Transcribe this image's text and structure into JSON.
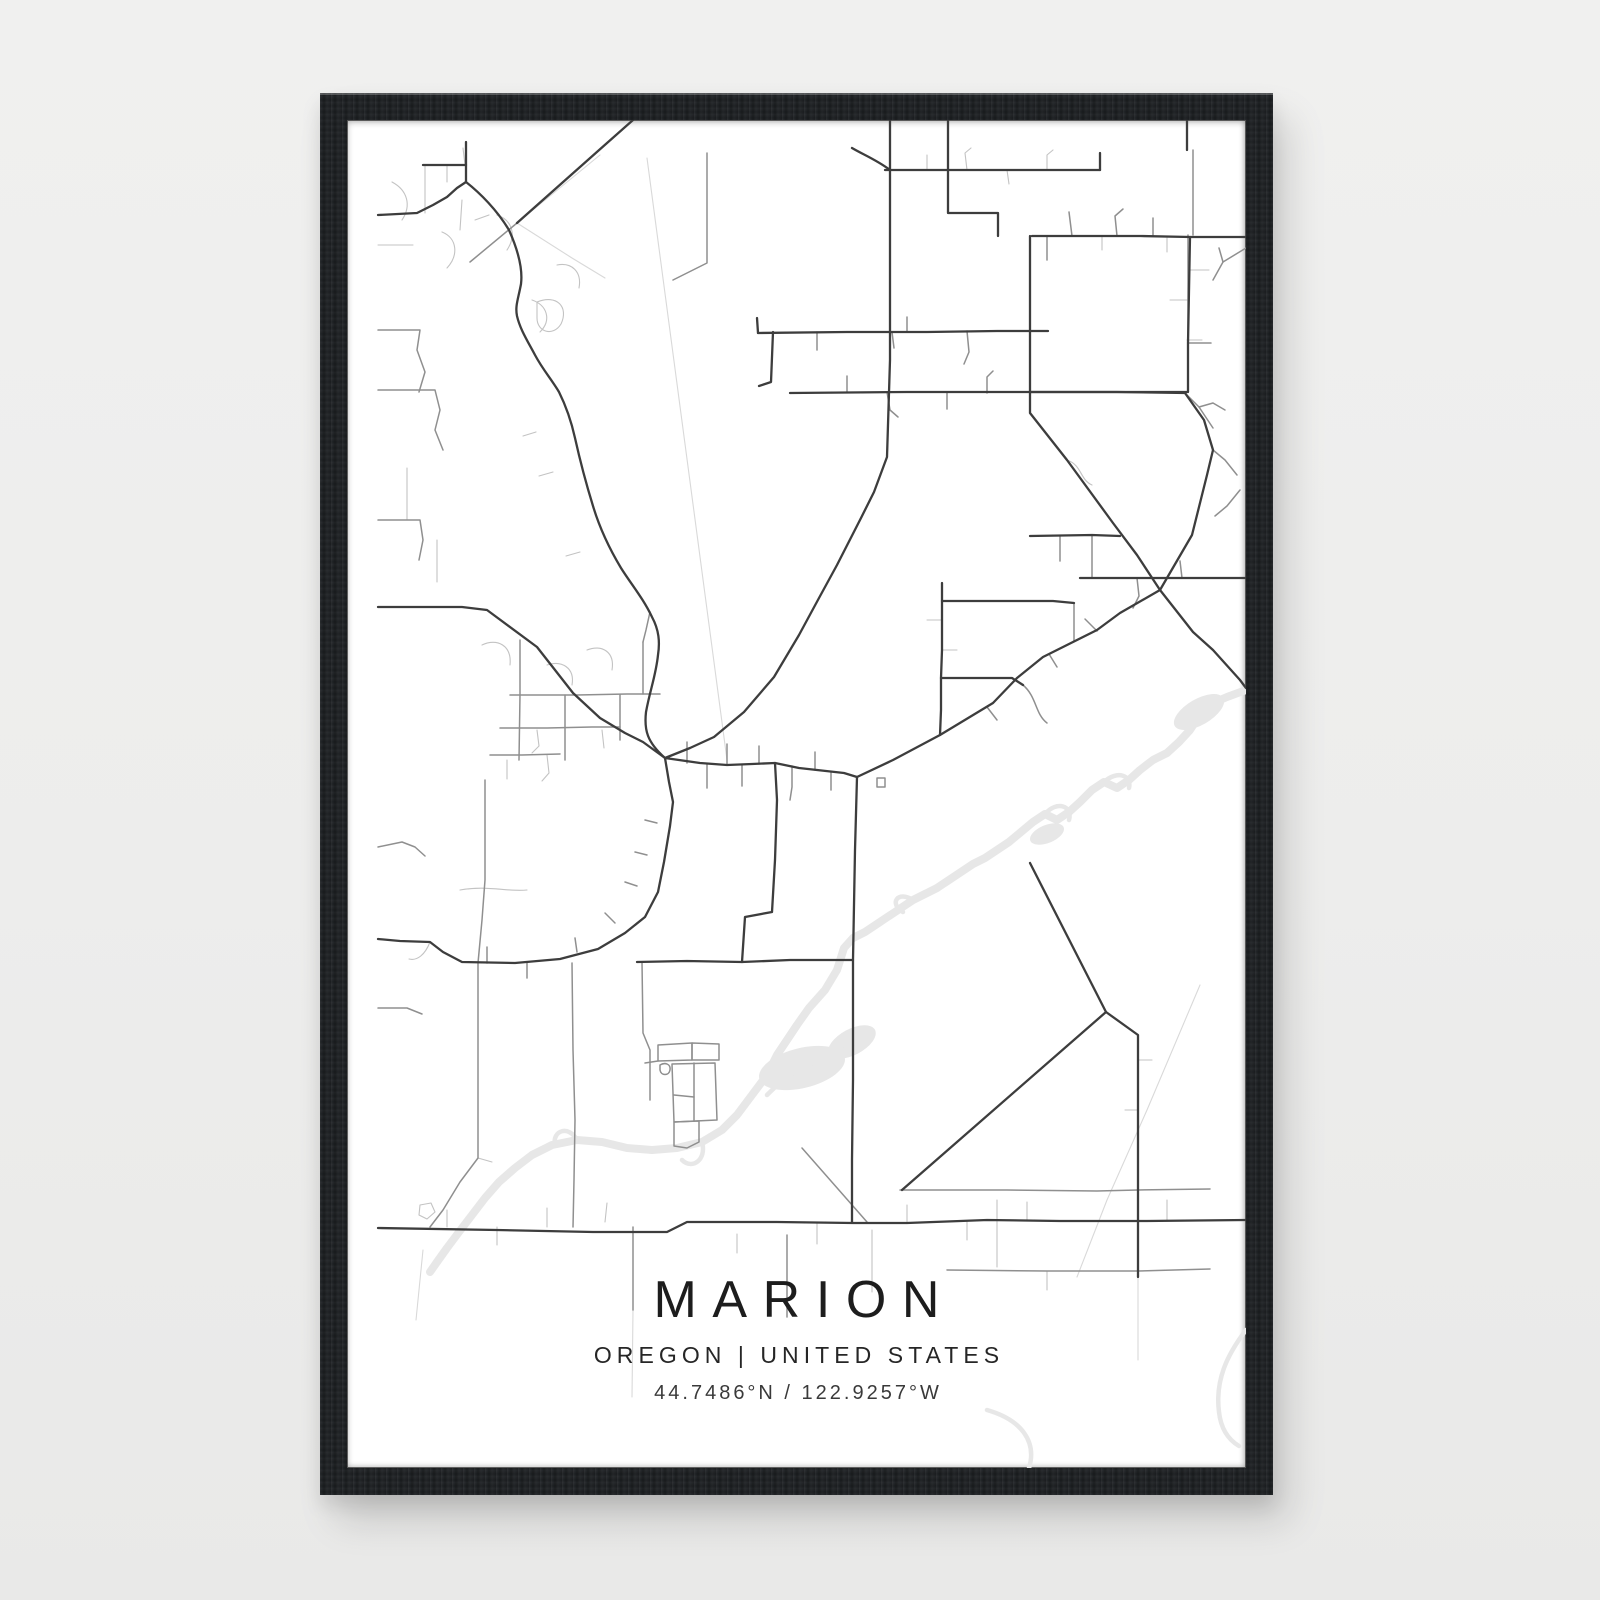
{
  "scene": {
    "background": "#eeeeee",
    "description": "framed-map-poster-product-photo"
  },
  "frame": {
    "color": "#202326",
    "material": "black-wood"
  },
  "poster": {
    "title": "MARION",
    "region": "OREGON",
    "country": "UNITED STATES",
    "region_line": "OREGON | UNITED STATES",
    "latitude": "44.7486°N",
    "longitude": "122.9257°W",
    "coordinates_line": "44.7486°N / 122.9257°W",
    "colors": {
      "paper": "#ffffff",
      "title_text": "#1d1d1d",
      "subtitle_text": "#262626",
      "coords_text": "#3a3a3a",
      "road_main": "#3d3d3d",
      "road_mid": "#8f8f8f",
      "road_minor": "#c3c3c3",
      "road_faint": "#d9d9d9",
      "water": "#e7e7e7"
    }
  },
  "map": {
    "viewbox": "0 0 899 1348",
    "blobs": [
      {
        "cx": 455,
        "cy": 948,
        "rx": 44,
        "ry": 20,
        "rot": -14,
        "color": "#e7e7e7"
      },
      {
        "cx": 505,
        "cy": 922,
        "rx": 26,
        "ry": 13,
        "rot": -28,
        "color": "#e7e7e7"
      },
      {
        "cx": 852,
        "cy": 592,
        "rx": 28,
        "ry": 13,
        "rot": -30,
        "color": "#e7e7e7"
      },
      {
        "cx": 700,
        "cy": 714,
        "rx": 18,
        "ry": 9,
        "rot": -22,
        "color": "#e7e7e7"
      }
    ],
    "layers": [
      {
        "name": "water",
        "color": "#e7e7e7",
        "width": 8,
        "paths": [
          "M899,570 L880,577 866,583 852,596 843,610 832,622 820,633 806,640 793,650 782,660 770,668 757,662 745,670 733,682 722,692 710,700 698,694 686,702 674,712 662,722 650,730 638,738 626,744 614,752 602,760 590,768 578,774 566,780 554,788 542,796 530,804 518,812 506,818 497,828 490,850 478,870 462,888 450,905 440,920 430,935 420,955 405,975 390,995 375,1010 355,1022 330,1028 305,1030 280,1028 255,1022 230,1020 205,1025 185,1035 168,1048 152,1062 138,1078 125,1095 112,1112 100,1128 90,1142 83,1152"
        ]
      },
      {
        "name": "water-side",
        "color": "#e7e7e7",
        "width": 4.5,
        "paths": [
          "M757,662 C770,650 785,655 782,668",
          "M698,694 C710,680 726,686 722,700",
          "M566,780 C550,770 542,784 556,792",
          "M355,1022 C360,1040 345,1050 335,1040",
          "M230,1020 C222,1005 205,1010 208,1025",
          "M505,925 C490,935 470,940 455,948 C440,956 430,965 420,975",
          "M899,1210 C880,1235 868,1260 872,1292 C874,1310 882,1320 892,1326",
          "M640,1290 C675,1300 690,1322 682,1348"
        ]
      },
      {
        "name": "road-faint",
        "color": "#d9d9d9",
        "width": 1.1,
        "paths": [
          "M300,38 L380,640",
          "M853,865 L800,990 760,1080 730,1157",
          "M253,35 L170,103 123,142",
          "M170,103 L225,138 258,158",
          "M76,1130 L72,1170 69,1200",
          "M286,1190 L285,1277",
          "M791,1157 L791,1240"
        ]
      },
      {
        "name": "road-minor",
        "color": "#c3c3c3",
        "width": 1.1,
        "paths": [
          "M45,62 C60,70 65,85 55,100",
          "M95,112 C110,118 112,135 100,148",
          "M150,95 C165,100 170,115 160,130",
          "M185,180 C200,185 205,200 193,212",
          "M210,145 C225,142 235,152 232,168",
          "M190,182 C210,174 222,187 214,204 C206,217 190,212 190,198 Z",
          "M60,348 L60,400",
          "M90,420 L90,462",
          "M31,125 L66,125",
          "M78,45 L78,93",
          "M100,45 L100,62",
          "M118,45 L116,28",
          "M115,80 L113,110",
          "M135,525 C150,518 165,525 163,545",
          "M200,545 C215,540 228,548 225,565",
          "M240,530 C255,524 268,532 265,550",
          "M190,610 L192,626 185,633",
          "M255,610 L257,628",
          "M160,640 L160,659",
          "M200,635 L202,653 195,661",
          "M128,100 L142,95",
          "M206,352 L192,356",
          "M233,432 L219,436",
          "M189,312 L176,316",
          "M720,340 C735,345 733,360 745,365",
          "M83,822 C78,835 70,841 62,839",
          "M73,1085 L84,1083 88,1092 80,1099 72,1095 Z",
          "M131,1038 L145,1042",
          "M100,1107 L100,1090",
          "M150,1107 L150,1125",
          "M200,1107 L200,1088",
          "M390,1114 L390,1133",
          "M470,1102 L470,1124",
          "M560,1103 L560,1085",
          "M620,1101 L620,1120",
          "M680,1101 L680,1082",
          "M820,1101 L820,1080",
          "M700,1151 L700,1170",
          "M791,940 L805,940",
          "M791,990 L778,990",
          "M595,500 L580,500",
          "M595,530 L610,530",
          "M843,150 L862,150",
          "M840,180 L823,180",
          "M840,220 L855,220",
          "M755,116 L755,130",
          "M820,118 L820,132",
          "M580,50 L580,35",
          "M620,50 L618,33 624,28",
          "M660,50 L662,64",
          "M700,50 L700,35 706,30",
          "M113,770 C140,765 160,772 180,770",
          "M260,1083 L258,1102",
          "M525,1110 L525,1172",
          "M650,1080 L650,1147"
        ]
      },
      {
        "name": "road-mid",
        "color": "#8f8f8f",
        "width": 1.5,
        "paths": [
          "M838,273 L852,287 866,308",
          "M852,287 L866,283 878,290",
          "M866,330 L878,340 890,355",
          "M893,370 L880,386 868,396",
          "M553,1070 L660,1070 750,1071 791,1070 863,1069",
          "M600,1150 L700,1151 791,1151 863,1149",
          "M131,843 L131,950 131,1038 113,1062 96,1090 83,1107",
          "M360,33 L360,100 360,143 326,160",
          "M163,575 L230,575 280,574 313,574",
          "M153,608 L200,608 245,607 273,607",
          "M143,635 L175,635 213,634",
          "M173,520 L173,575 172,640",
          "M218,575 L218,640",
          "M273,575 L273,620",
          "M296,522 L296,574",
          "M303,492 L299,510 296,522",
          "M138,660 L138,760 135,800 131,843",
          "M340,643 L340,622",
          "M360,644 L360,668",
          "M380,645 L380,624",
          "M395,645 L395,666",
          "M412,644 L412,626",
          "M445,646 L445,667 443,680",
          "M468,650 L468,632",
          "M484,652 L484,670",
          "M530,658 L538,658 538,667 530,667 Z",
          "M298,700 L310,703",
          "M288,732 L300,735",
          "M278,762 L290,766",
          "M258,793 L268,803",
          "M228,818 L230,832",
          "M180,843 L180,858",
          "M140,843 L140,827",
          "M31,210 L73,210 70,230 78,252 72,272",
          "M31,270 L88,270 93,290 88,310 96,330",
          "M31,400 L73,400 76,420 72,440",
          "M31,727 L55,722 68,727 78,736",
          "M31,888 L60,888 75,894",
          "M470,212 L470,230",
          "M560,212 L560,197",
          "M620,211 L622,232 617,244",
          "M545,212 L547,228",
          "M500,272 L500,256",
          "M540,272 L543,290 551,297",
          "M600,272 L600,289",
          "M640,273 L640,257 646,251",
          "M700,116 L700,140",
          "M722,92 L725,116",
          "M770,116 L768,96 776,89",
          "M806,116 L806,98",
          "M745,416 L745,458",
          "M713,416 L713,441",
          "M790,458 L792,476 786,488",
          "M835,458 L833,441",
          "M727,483 L727,521",
          "M676,565 C690,577 688,594 700,603",
          "M640,587 L650,600",
          "M702,534 L710,547",
          "M738,499 L750,511",
          "M899,128 L876,142 866,160",
          "M876,142 L872,128",
          "M311,925 L345,923 345,940 311,941 Z",
          "M345,923 L372,924 372,940 345,940 Z",
          "M325,944 L368,943 370,1000 327,1002 Z",
          "M347,943 L347,1001",
          "M327,975 L347,977",
          "M327,1002 L352,1001 352,1022 340,1028 327,1026 Z",
          "M311,941 L298,943",
          "M313,945 C318,942 324,944 323,950 C322,956 314,956 313,950 Z",
          "M225,843 L226,930 228,1000 227,1060 226,1107",
          "M295,842 L296,913 303,930 303,980",
          "M286,1107 L286,1190",
          "M440,1115 L440,1197",
          "M455,1028 L520,1102",
          "M170,103 L123,142",
          "M846,30 L846,115",
          "M841,115 L841,223 L864,223"
        ]
      },
      {
        "name": "road-main",
        "color": "#3d3d3d",
        "width": 2.3,
        "paths": [
          "M31,95 L70,93 86,85 100,77 110,68 119,62",
          "M76,45 L119,45",
          "M119,22 L119,62 C133,73 150,90 162,110 C170,128 176,148 174,164 C171,180 168,186 170,196 C173,209 180,220 188,235 C196,250 205,260 212,272 C218,284 224,300 228,318 C232,336 238,360 246,386 C252,406 262,428 274,448 C284,464 296,478 305,497 C312,510 313,522 311,535 C309,555 303,570 299,592 C297,610 300,622 318,638",
          "M318,638 L322,662 326,682 323,706 317,742 311,772 298,797 278,813 251,829 213,839 168,843 115,842 96,832 83,822 53,821 31,819",
          "M505,28 C515,34 530,40 543,50 L543,240 540,337 527,372 514,398 490,445 472,478 452,515 427,557 397,592 367,617 343,628 318,638",
          "M543,0 L543,50",
          "M318,638 L353,643 380,645 405,644 428,643 452,648 470,650 497,653 510,657",
          "M510,657 L546,640 593,615 646,583 670,558 696,537 750,510 773,493 813,470 845,415 860,355 866,330 857,300 838,273",
          "M443,273 L560,272 683,272 770,272 838,273",
          "M538,50 L641,50 700,50 753,50",
          "M753,33 L753,50",
          "M601,0 L601,60 601,93 L651,93 651,116",
          "M685,116 L793,116 843,117 841,223 841,272 683,272 683,116",
          "M843,117 L899,117",
          "M683,272 L683,293 720,340 766,403 790,435 813,470",
          "M813,470 L846,512 866,530 893,560 899,568",
          "M411,213 L500,212 580,212 650,211 701,211",
          "M411,213 L410,198",
          "M286,0 L251,31 170,103",
          "M595,463 L595,530 594,558 594,590 593,615",
          "M594,558 L640,558 665,558 676,565",
          "M595,481 L650,481 706,481 727,483",
          "M428,643 L430,680 428,740 425,792 398,797 395,842",
          "M290,842 L340,841 395,842 443,840 506,840",
          "M31,1108 L150,1110 246,1112 320,1112 340,1102 430,1102 506,1103 560,1103 640,1100 713,1101 800,1101 899,1100",
          "M510,657 L508,730 506,840 506,960 505,1040 505,1102",
          "M683,743 L759,892 L555,1070",
          "M759,892 L791,915 791,1003 791,1070 791,1157",
          "M31,487 L90,487 115,487 140,490 190,527 226,573 253,598 278,613 296,622 318,638",
          "M733,458 L820,458 899,458",
          "M683,416 L745,415 773,416",
          "M426,212 L424,262 412,266",
          "M840,0 L840,30"
        ]
      }
    ]
  }
}
